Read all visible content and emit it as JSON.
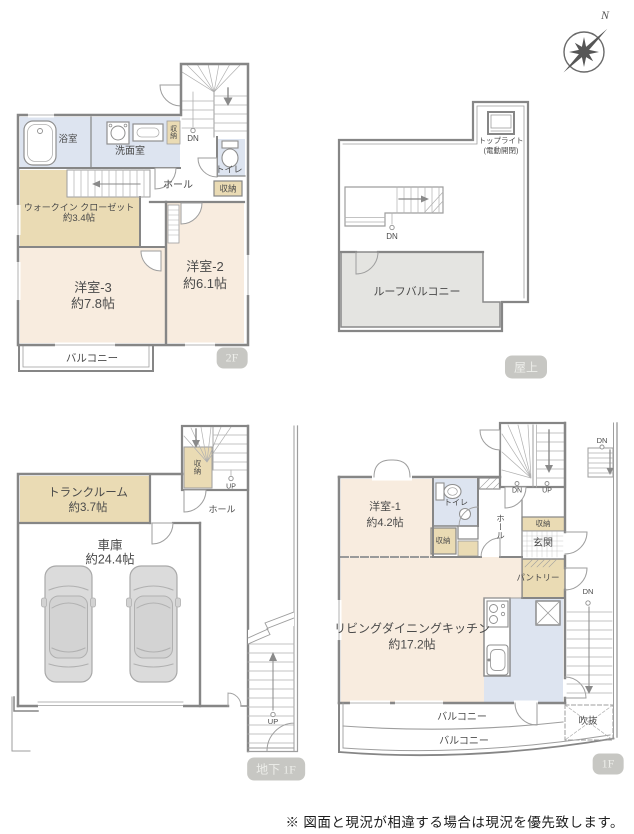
{
  "sheet": {
    "note": "※ 図面と現況が相違する場合は現況を優先致します。",
    "compass_label": "N"
  },
  "colors": {
    "room_pink": "#f8ecdf",
    "closet_tan": "#eadbb4",
    "wet_blue": "#dde4f0",
    "terrace_gray": "#e4e4e1",
    "wall_gray": "#868686",
    "badge_gray": "#c7c7c3"
  },
  "floor_2f": {
    "badge": "2F",
    "labels": {
      "bathroom": "浴室",
      "washroom": "洗面室",
      "storage_top": "収納",
      "stair_dn": "DN",
      "toilet": "トイレ",
      "storage_hall": "収納",
      "hall": "ホール",
      "wic_name": "ウォークイン クローゼット",
      "wic_size": "約3.4帖",
      "bedroom3_name": "洋室-3",
      "bedroom3_size": "約7.8帖",
      "bedroom2_name": "洋室-2",
      "bedroom2_size": "約6.1帖",
      "balcony": "バルコニー"
    }
  },
  "floor_roof": {
    "badge": "屋上",
    "labels": {
      "toplight_name": "トップライト",
      "toplight_note": "(電動開閉)",
      "stair_dn": "DN",
      "roof_balcony": "ルーフバルコニー"
    }
  },
  "floor_b1": {
    "badge": "地下 1F",
    "labels": {
      "trunk_name": "トランクルーム",
      "trunk_size": "約3.7帖",
      "storage": "収納",
      "stair_up": "UP",
      "hall": "ホール",
      "garage_name": "車庫",
      "garage_size": "約24.4帖",
      "outdoor_up": "UP"
    }
  },
  "floor_1f": {
    "badge": "1F",
    "labels": {
      "outer_dn": "DN",
      "stair_dn": "DN",
      "stair_up": "UP",
      "bedroom1_name": "洋室-1",
      "bedroom1_size": "約4.2帖",
      "toilet": "トイレ",
      "storage_toilet": "収納",
      "hall": "ホール",
      "storage_entrance": "収納",
      "entrance": "玄関",
      "pantry": "パントリー",
      "ldk_name": "リビングダイニングキッチン",
      "ldk_size": "約17.2帖",
      "side_dn": "DN",
      "balcony_inner": "バルコニー",
      "balcony_outer": "バルコニー",
      "void": "吹抜"
    }
  }
}
